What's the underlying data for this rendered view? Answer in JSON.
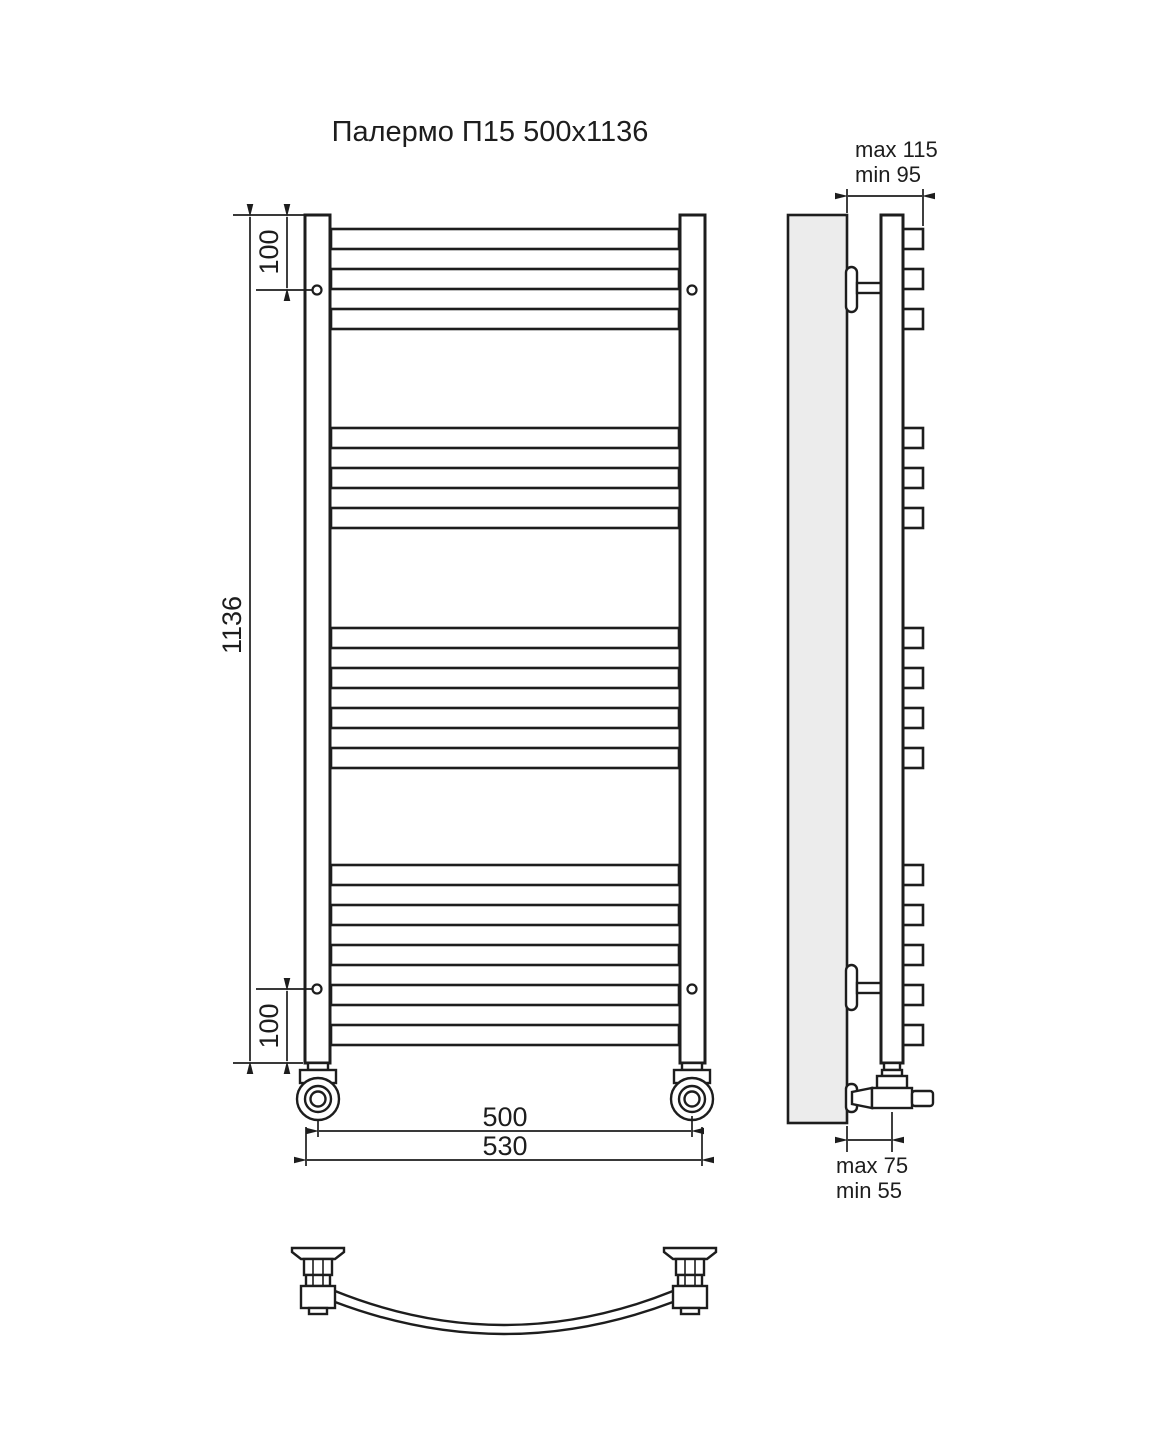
{
  "title": "Палермо П15 500х1136",
  "colors": {
    "line": "#1d1d1d",
    "wall_fill": "#ececec",
    "background": "#ffffff"
  },
  "dimensions": {
    "height": "1136",
    "top_hole_offset": "100",
    "bottom_hole_offset": "100",
    "hole_spacing_width": "500",
    "overall_width": "530",
    "top_wall_distance_max": "max 115",
    "top_wall_distance_min": "min 95",
    "bottom_wall_distance_max": "max 75",
    "bottom_wall_distance_min": "min 55"
  },
  "front_view": {
    "total_rungs": 15,
    "rung_groups": [
      {
        "tubes": [
          [
            229,
            249
          ],
          [
            269,
            289
          ],
          [
            309,
            329
          ]
        ]
      },
      {
        "tubes": [
          [
            428,
            448
          ],
          [
            468,
            488
          ],
          [
            508,
            528
          ]
        ]
      },
      {
        "tubes": [
          [
            628,
            648
          ],
          [
            668,
            688
          ],
          [
            708,
            728
          ],
          [
            748,
            768
          ]
        ]
      },
      {
        "tubes": [
          [
            865,
            885
          ],
          [
            905,
            925
          ],
          [
            945,
            965
          ],
          [
            985,
            1005
          ],
          [
            1025,
            1045
          ]
        ]
      }
    ],
    "mount_holes": [
      [
        317,
        290
      ],
      [
        692,
        290
      ],
      [
        317,
        989
      ],
      [
        692,
        989
      ]
    ]
  }
}
